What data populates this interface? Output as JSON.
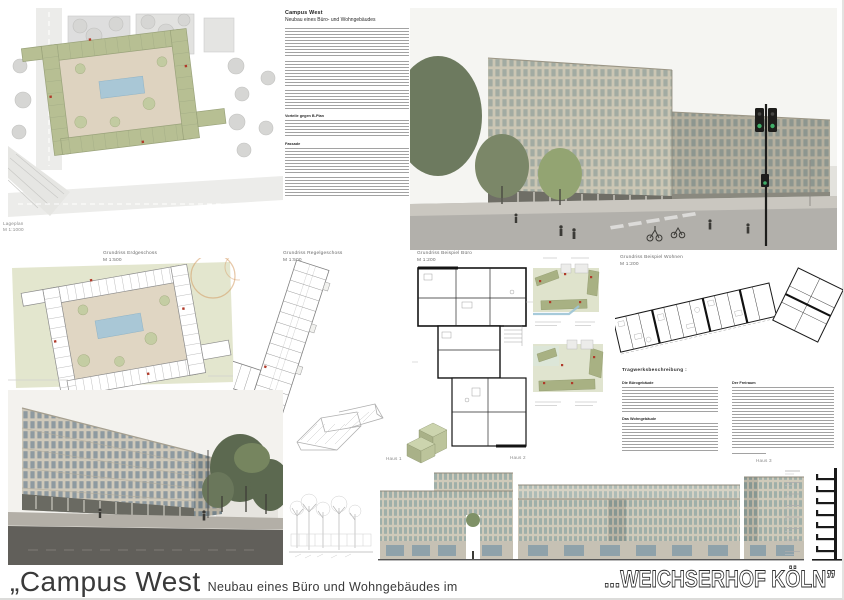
{
  "footer": {
    "title_main": "„Campus West",
    "title_sub": "Neubau eines Büro und Wohngebäudes im",
    "title_right": "...WEICHSERHOF KÖLN”"
  },
  "site_plan": {
    "label": "Lageplan",
    "scale": "M 1:1000"
  },
  "description": {
    "title": "Campus West",
    "subtitle": "Neubau eines Büro- und Wohngebäudes",
    "section1": "Vorteile gegen B-Plan",
    "section2": "Fassade"
  },
  "plan_labels": {
    "erdgeschoss": {
      "title": "Grundriss Erdgeschoss",
      "scale": "M 1:500"
    },
    "regelgeschoss": {
      "title": "Grundriss Regelgeschoss",
      "scale": "M 1:500"
    },
    "beispiel_buero": {
      "title": "Grundriss Beispiel Büro",
      "scale": "M 1:200"
    },
    "beispiel_wohnen": {
      "title": "Grundriss Beispiel Wohnen",
      "scale": "M 1:200"
    }
  },
  "structure": {
    "heading": "Tragwerksbeschreibung :",
    "sub1": "Die Bürogebäude",
    "sub2": "Das Wohngebäude",
    "sub3": "Der Freiraum"
  },
  "elevation_labels": {
    "haus1": "Haus 1",
    "haus2": "Haus 2",
    "haus3": "Haus 3"
  },
  "colors": {
    "site_green": "#b7bf93",
    "courtyard_beige": "#ded3c0",
    "pool_blue": "#a9c7d6",
    "accent_red": "#b03a2a",
    "facade_tan": "#cbc6b4",
    "glass_green": "#9fa8a1",
    "ink": "#3a3a3a"
  }
}
